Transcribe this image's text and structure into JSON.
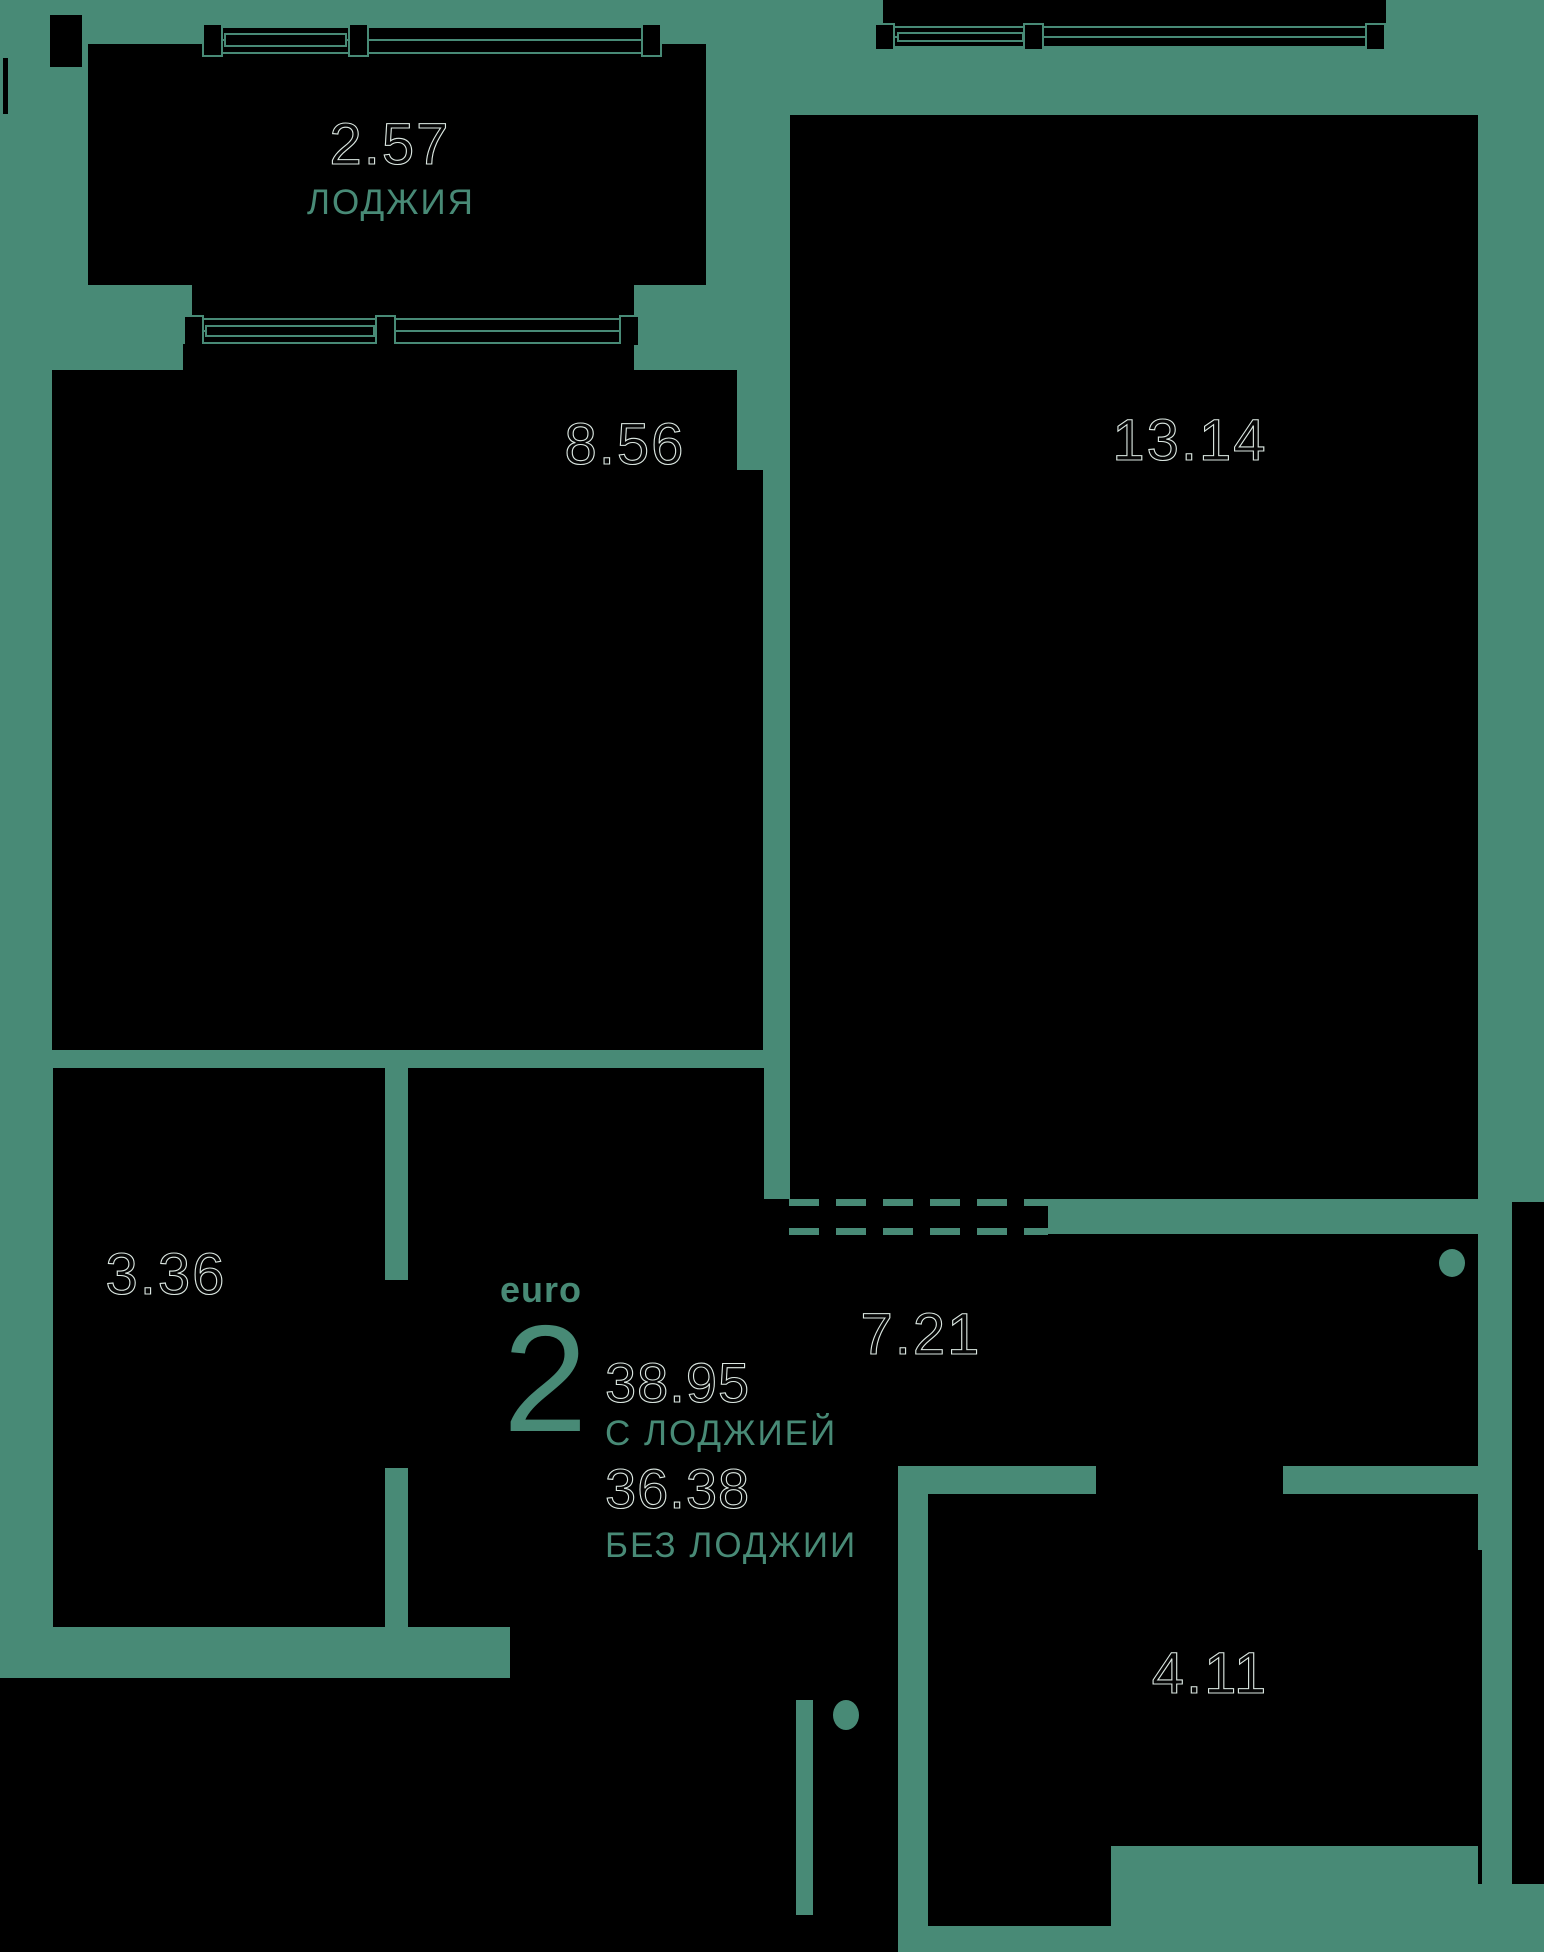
{
  "meta": {
    "title": "Apartment floor plan"
  },
  "colors": {
    "background": "#488a76",
    "room_fill": "#000000",
    "accent_text": "#488a76",
    "outline_number_stroke": "#dce8e2"
  },
  "summary": {
    "type_label": "euro",
    "rooms_count": "2",
    "area_with_loggia": "38.95",
    "with_loggia_label": "С ЛОДЖИЕЙ",
    "area_without_loggia": "36.38",
    "without_loggia_label": "БЕЗ ЛОДЖИИ"
  },
  "rooms": [
    {
      "name": "loggia",
      "area": "2.57",
      "label": "ЛОДЖИЯ"
    },
    {
      "name": "kitchen",
      "area": "8.56",
      "label": ""
    },
    {
      "name": "living-room",
      "area": "13.14",
      "label": ""
    },
    {
      "name": "bathroom",
      "area": "3.36",
      "label": ""
    },
    {
      "name": "hallway",
      "area": "7.21",
      "label": ""
    },
    {
      "name": "storage",
      "area": "4.11",
      "label": ""
    }
  ]
}
